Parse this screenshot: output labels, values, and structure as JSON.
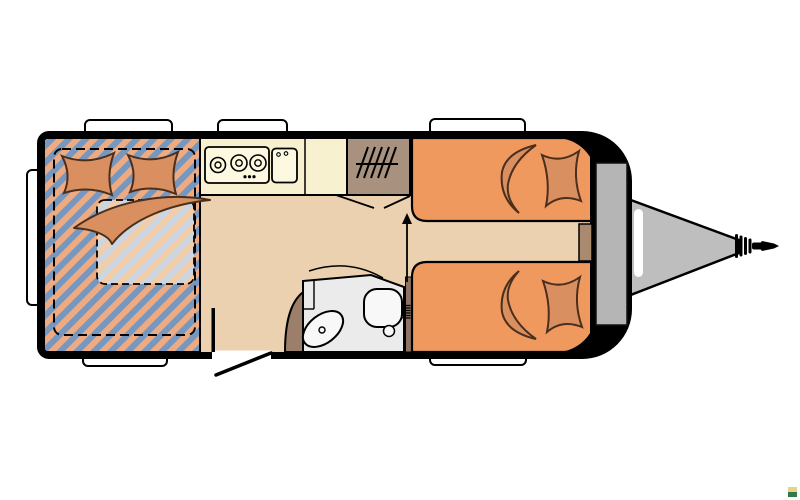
{
  "image": {
    "kind": "caravan-floorplan",
    "background": "#ffffff"
  },
  "colors": {
    "outline": "#000000",
    "floor": "#ebd1b0",
    "stripe_blue": "#7597c0",
    "stripe_orange": "#eeab81",
    "stripe_blue_light": "#ccd6e3",
    "stripe_orange_light": "#f2cda7",
    "bed_orange": "#f0995f",
    "cushion_orange": "#d98f5f",
    "counter_cream": "#f8f1cf",
    "appliance_cream": "#fdf8e0",
    "wardrobe_brown": "#a8917e",
    "cabinet_brown": "#a98a6e",
    "bath_door_brown": "#9c7f6a",
    "bath_wall_brown": "#8e7363",
    "bathroom_grey": "#ebebeb",
    "fixture_white": "#f8f8f8",
    "locker_grey": "#b5b5b5",
    "drawbar_grey": "#bebebe",
    "window_white": "#ffffff",
    "watermark_yellow": "#e9d386",
    "watermark_green": "#2f7a4a"
  },
  "fixtures": {
    "left_bed": "french-double-bed",
    "kitchen": "hob-and-sink-kitchen",
    "wardrobe": "wardrobe-with-hangers",
    "bathroom": "washroom-toilet-and-basin",
    "bed_top_right": "single-bed",
    "bed_bottom_right": "single-bed",
    "front": "gas-locker-with-drawbar-hitch",
    "entry": "entrance-door"
  }
}
